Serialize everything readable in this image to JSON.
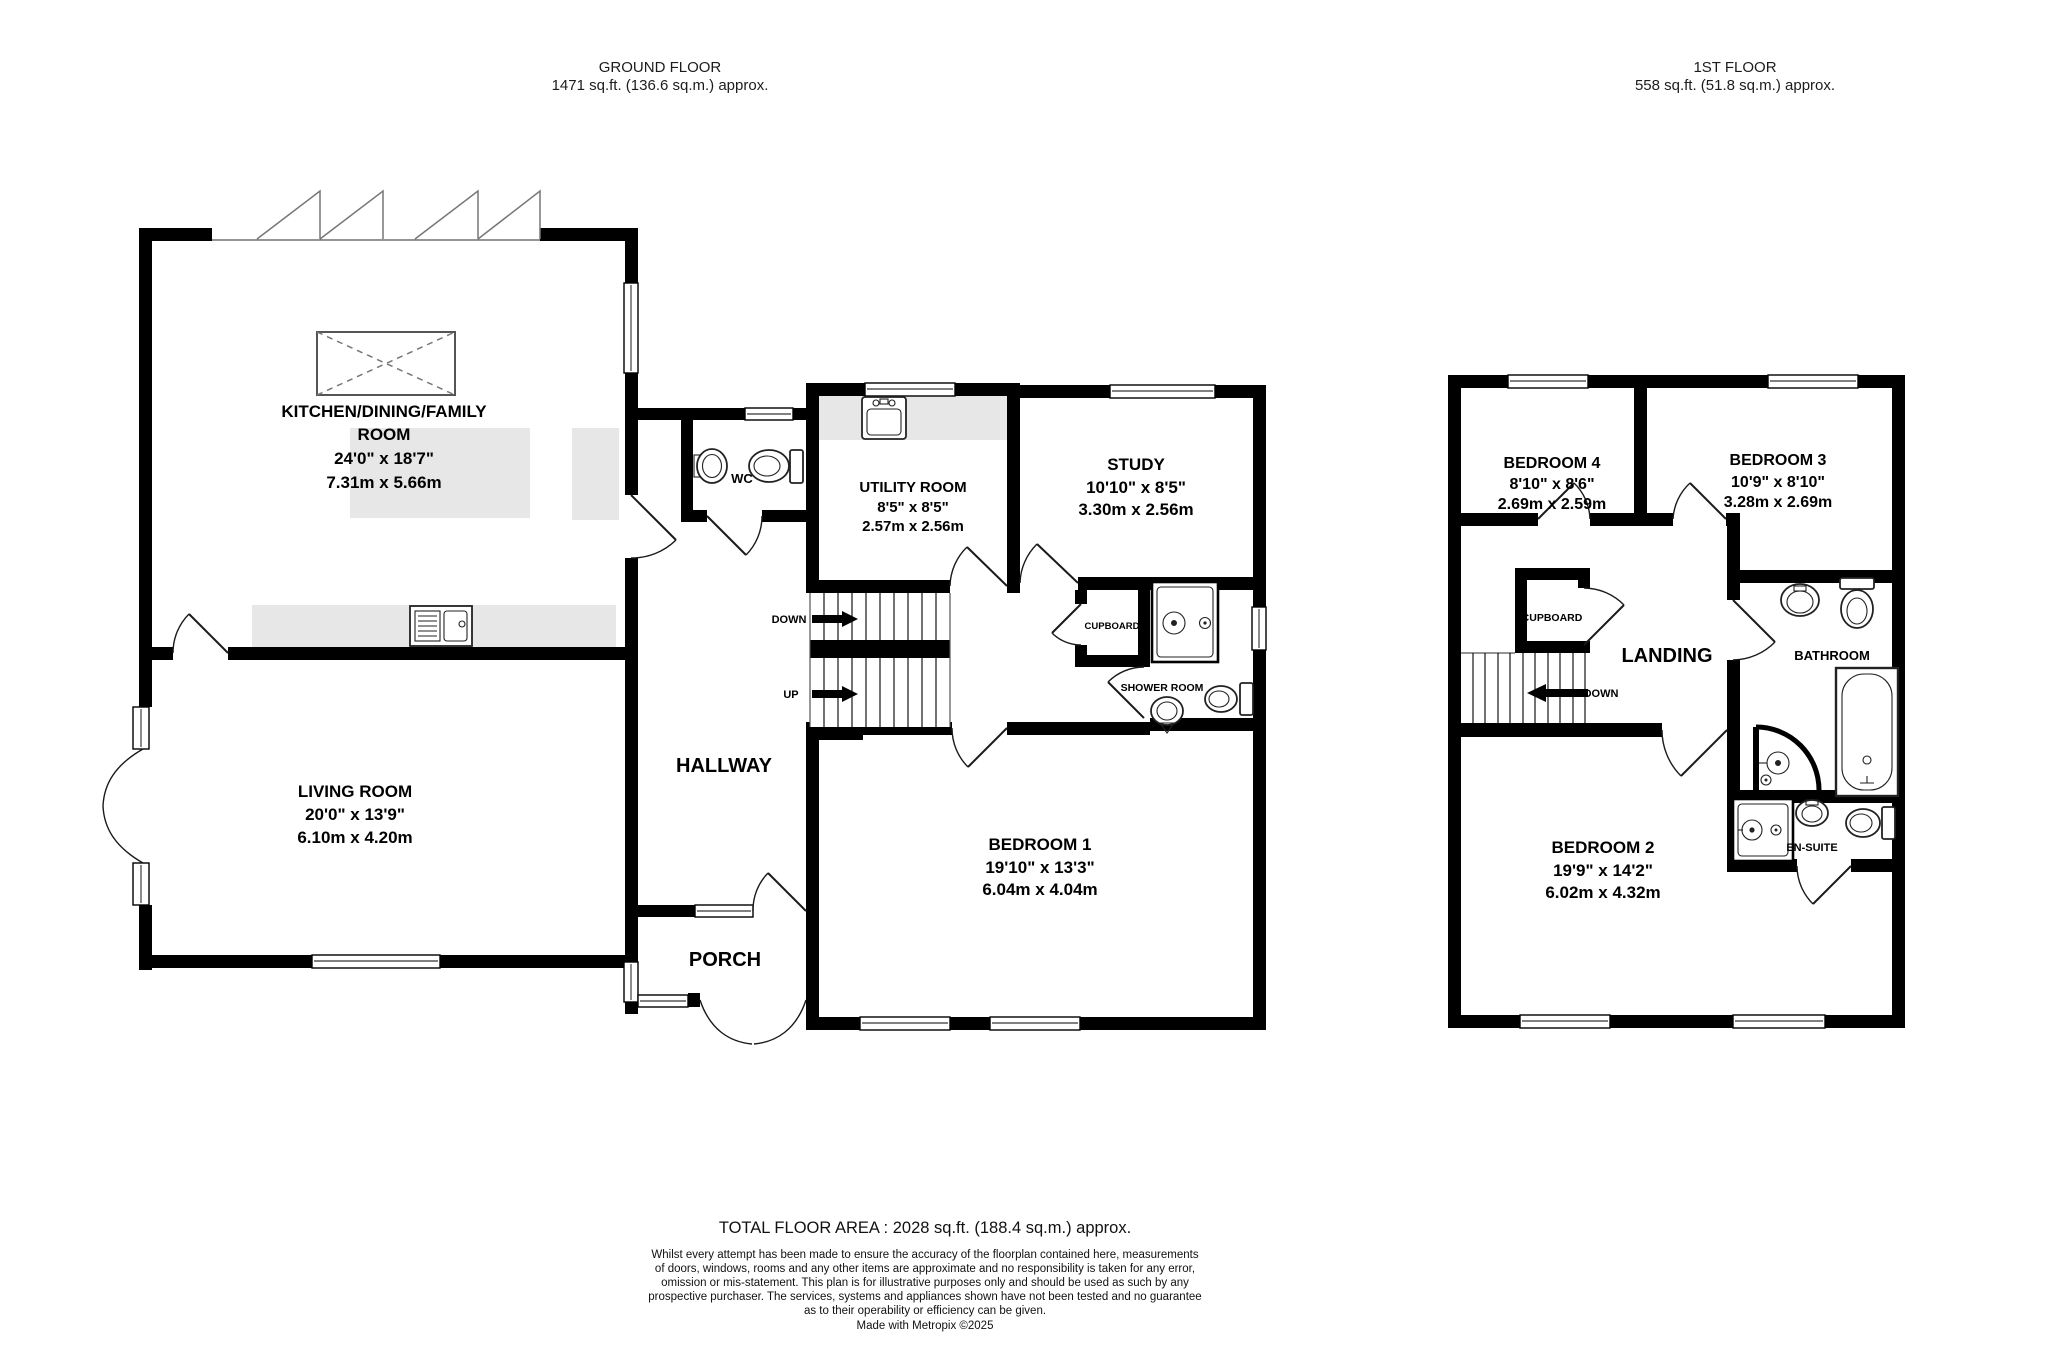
{
  "ground_floor": {
    "header": {
      "title": "GROUND FLOOR",
      "area": "1471 sq.ft. (136.6 sq.m.) approx."
    },
    "rooms": {
      "kitchen": {
        "name_line1": "KITCHEN/DINING/FAMILY",
        "name_line2": "ROOM",
        "imperial": "24'0\"  x 18'7\"",
        "metric": "7.31m  x 5.66m"
      },
      "living": {
        "name": "LIVING ROOM",
        "imperial": "20'0\"  x 13'9\"",
        "metric": "6.10m  x 4.20m"
      },
      "utility": {
        "name": "UTILITY ROOM",
        "imperial": "8'5\"  x 8'5\"",
        "metric": "2.57m  x 2.56m"
      },
      "study": {
        "name": "STUDY",
        "imperial": "10'10\"  x 8'5\"",
        "metric": "3.30m  x 2.56m"
      },
      "bedroom1": {
        "name": "BEDROOM 1",
        "imperial": "19'10\"  x 13'3\"",
        "metric": "6.04m  x 4.04m"
      },
      "wc": {
        "name": "WC"
      },
      "hallway": {
        "name": "HALLWAY"
      },
      "porch": {
        "name": "PORCH"
      },
      "cupboard": {
        "name": "CUPBOARD"
      },
      "shower_room": {
        "name": "SHOWER ROOM"
      }
    },
    "stairs": {
      "down": "DOWN",
      "up": "UP"
    }
  },
  "first_floor": {
    "header": {
      "title": "1ST FLOOR",
      "area": "558 sq.ft. (51.8 sq.m.) approx."
    },
    "rooms": {
      "bedroom4": {
        "name": "BEDROOM 4",
        "imperial": "8'10\"  x 8'6\"",
        "metric": "2.69m  x 2.59m"
      },
      "bedroom3": {
        "name": "BEDROOM 3",
        "imperial": "10'9\"  x 8'10\"",
        "metric": "3.28m  x 2.69m"
      },
      "bedroom2": {
        "name": "BEDROOM 2",
        "imperial": "19'9\"  x 14'2\"",
        "metric": "6.02m  x 4.32m"
      },
      "landing": {
        "name": "LANDING"
      },
      "bathroom": {
        "name": "BATHROOM"
      },
      "ensuite": {
        "name": "EN-SUITE"
      },
      "cupboard": {
        "name": "CUPBOARD"
      }
    },
    "stairs": {
      "down": "DOWN"
    }
  },
  "footer": {
    "total_area": "TOTAL FLOOR AREA : 2028 sq.ft. (188.4 sq.m.) approx.",
    "disclaimer_lines": [
      "Whilst every attempt has been made to ensure the accuracy of the floorplan contained here, measurements",
      "of doors, windows, rooms and any other items are approximate and no responsibility is taken for any error,",
      "omission or mis-statement. This plan is for illustrative purposes only and should be used as such by any",
      "prospective purchaser. The services, systems and appliances shown have not been tested and no guarantee",
      "as to their operability or efficiency can be given."
    ],
    "credit": "Made with Metropix ©2025"
  },
  "colors": {
    "wall": "#000000",
    "counter": "#e7e7e7",
    "fixture": "#222222",
    "text": "#000000"
  }
}
